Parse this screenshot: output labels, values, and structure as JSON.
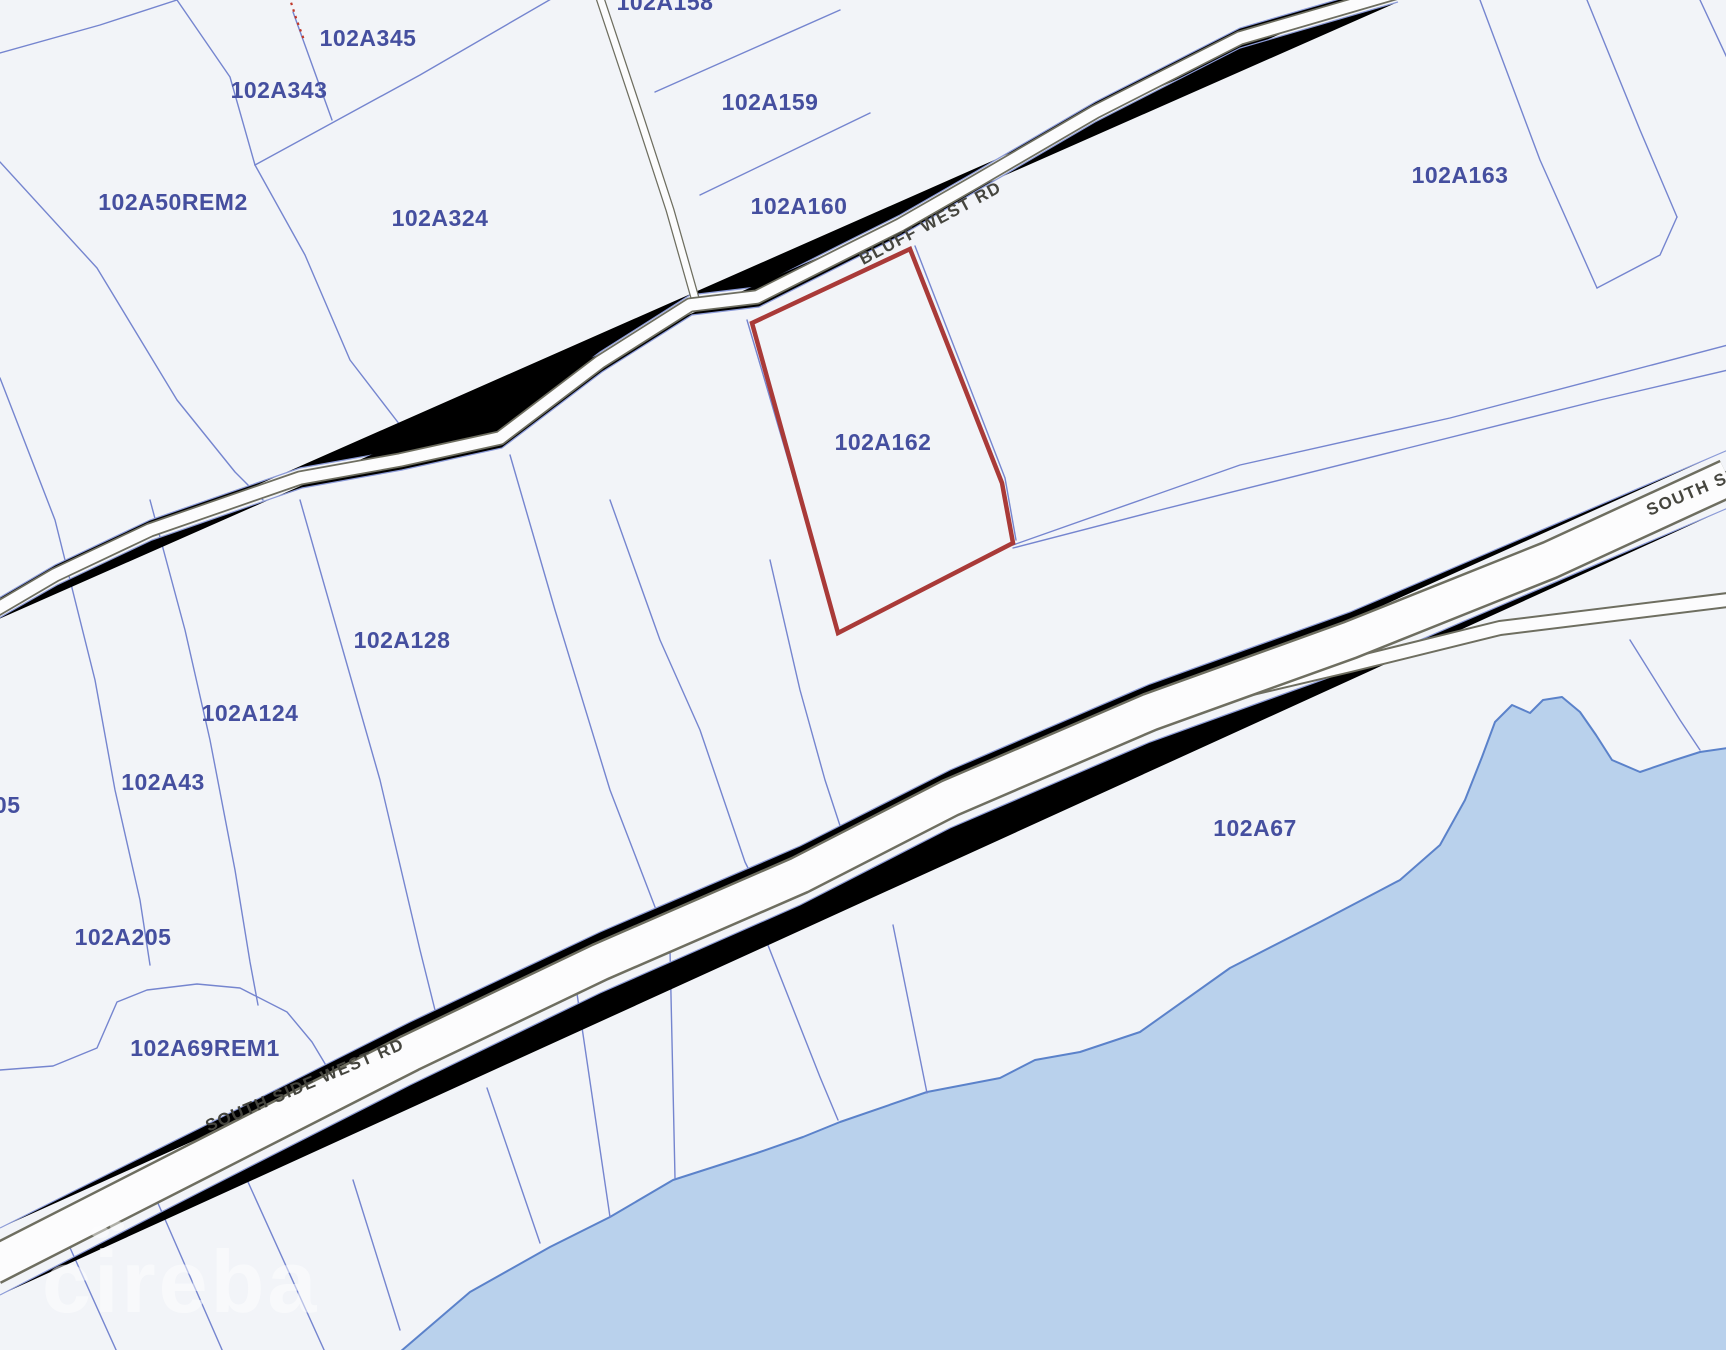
{
  "map": {
    "type": "cadastral-parcel-map",
    "parcels": [
      "102A158",
      "102A345",
      "102A343",
      "102A50REM2",
      "102A324",
      "102A159",
      "102A160",
      "102A163",
      "102A162",
      "102A128",
      "102A124",
      "102A43",
      "A205",
      "102A205",
      "102A69REM1",
      "102A67"
    ],
    "roads": {
      "bluff_west_rd": "BLUFF WEST RD",
      "south_side_west_rd": "SOUTH SIDE WEST RD",
      "south_side_partial": "SOUTH SI"
    },
    "highlight": {
      "parcel": "102A162",
      "outline_color": "#a93a38"
    },
    "watermark": {
      "text": "cireba"
    },
    "colors": {
      "background": "#f2f4f8",
      "parcel_line": "#7585cf",
      "parcel_label_text": "#454f9f",
      "road_edge": "#6e6e60",
      "road_label_text": "#45453e",
      "water_fill": "#b9d1ec",
      "water_edge": "#5b82ca"
    }
  }
}
